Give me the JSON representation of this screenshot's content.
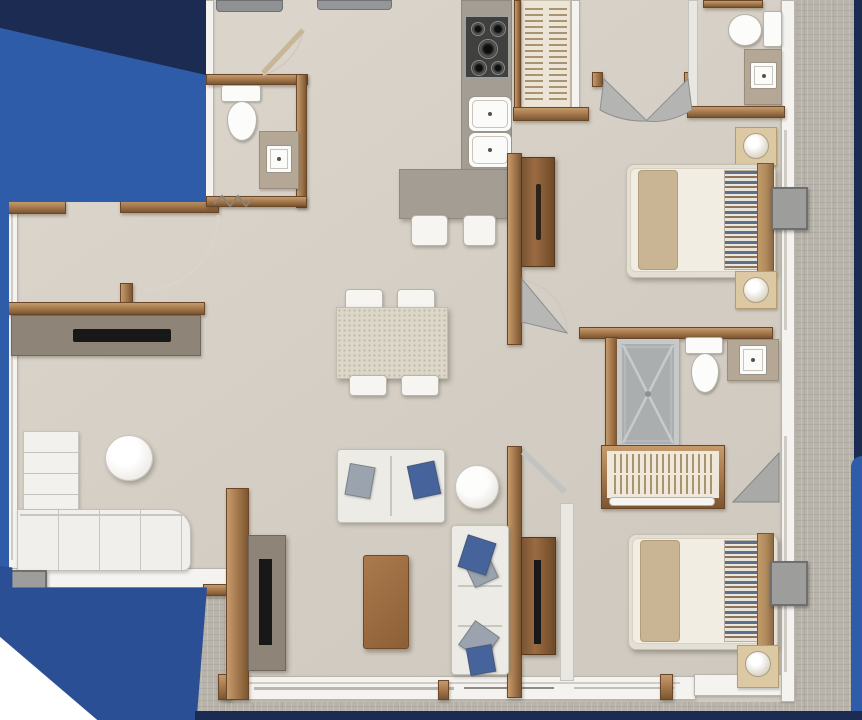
{
  "scene": {
    "kind": "apartment-floor-plan-render",
    "view": "top-down"
  },
  "palette": {
    "navy": "#1c2b52",
    "blue": "#2e5ca8",
    "blueWedge": "#2b4f95",
    "terrace": "#b8b4ab",
    "floor": "#d8d2c9",
    "wall": "#f4f3f0",
    "wallEdge": "#b8b5ae",
    "wood": "#a87c50",
    "woodDark": "#7c5631",
    "woodLight": "#c59a6b",
    "counter": "#a39d94",
    "taupe2": "#b5a795",
    "acGray": "#9d9d9b",
    "pillowBlue": "#5d6f8e",
    "pillowTan": "#8d7458",
    "cushionBlue": "#46639b",
    "cushionGray": "#9ba4ae",
    "tableWood": "#9a6b42",
    "consoleTaupe": "#8e8478",
    "tvBlack": "#181818"
  },
  "labels": {
    "entry": "entry",
    "kitchen": "kitchen",
    "dining": "dining-area",
    "living": "living-room",
    "hallway": "hallway",
    "bedroom_top": "bedroom-1",
    "bedroom_bottom": "bedroom-2",
    "bathroom_powder": "powder-bathroom",
    "bathroom_ensuite_top": "ensuite-bathroom-1",
    "bathroom_middle": "bathroom-2",
    "closet_top": "closet-1",
    "closet_middle": "closet-2",
    "terrace": "terrace",
    "bed": "double-bed",
    "sofa": "sofa",
    "chaise": "chaise-sofa",
    "dining_table": "dining-table",
    "coffee_table": "coffee-table",
    "tv_console": "tv-console",
    "shower": "shower",
    "toilet": "toilet",
    "vanity_sink": "vanity-sink",
    "stove": "stove-cooktop",
    "kitchen_sink": "double-kitchen-sink",
    "island": "kitchen-island",
    "stool": "bar-stool",
    "washer": "appliance",
    "ac_unit": "condenser-unit",
    "nightstand": "nightstand-with-lamp",
    "wardrobe": "wardrobe-door-panel",
    "shelf": "shelf-unit",
    "bench": "bench-sofa",
    "pouf": "round-pouf",
    "side_table": "round-side-table"
  }
}
